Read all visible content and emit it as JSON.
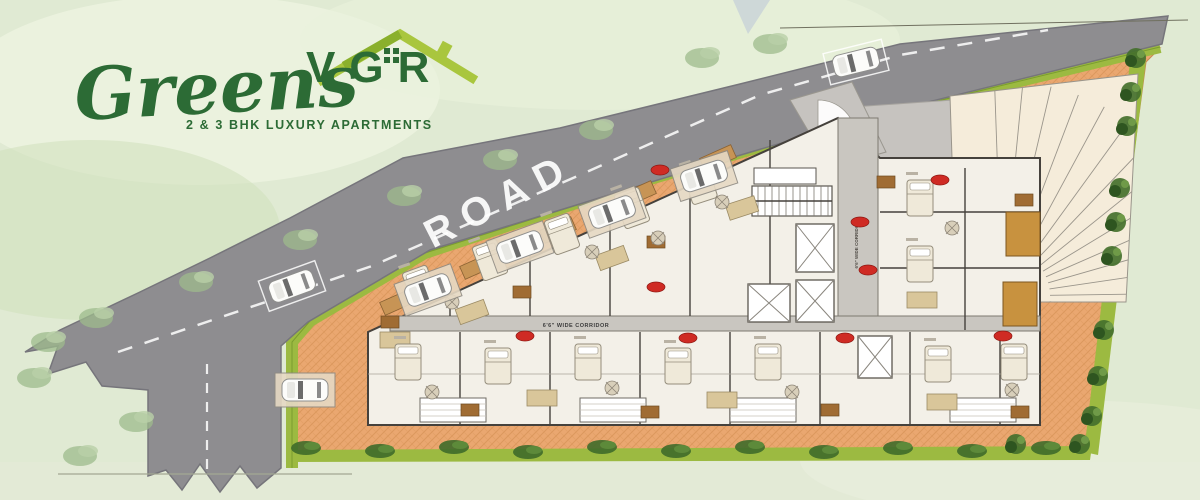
{
  "meta": {
    "title": "VGR Greens – Site / Floor Plan"
  },
  "logo": {
    "brand": "VGR",
    "name": "Greens",
    "tagline": "2 & 3 BHK LUXURY APARTMENTS",
    "dark_green": "#2c6b35",
    "light_green": "#a9c63e"
  },
  "road": {
    "label": "ROAD"
  },
  "plan": {
    "corridor_label": "6'6\" WIDE CORRIDOR",
    "corridor_label_vertical": "6'6\" WIDE CORRIDOR"
  },
  "colors": {
    "bg": "#e0ead3",
    "bg_wash1": "#eef4e1",
    "bg_wash2": "#cfe0bb",
    "road": "#8e8d90",
    "road_edge": "#76757b",
    "dash": "#ffffff",
    "green_strip": "#9cba41",
    "green_dark": "#7a9c2e",
    "plot": "#eaa770",
    "plot_line": "#d08b4e",
    "court": "#c6c3bf",
    "ramp": "#f5ecda",
    "ramp_line": "#9a958b",
    "floor": "#f3f0e8",
    "wall": "#45413c",
    "inner_wall": "#a9a399",
    "tan": "#d9c69a",
    "gold": "#c8923f",
    "brown": "#a06c33",
    "bed": "#efe9d9",
    "bed_line": "#948d7c",
    "badge": "#cf2b24",
    "tree_dark": "#44702c",
    "tree_darker": "#2e5520",
    "tree_light": "#9dbb8c",
    "bush": "#3f6b2a",
    "white": "#ffffff",
    "smudge": "#b9b2a4"
  },
  "cars": {
    "on_road": [
      {
        "x": 856,
        "y": 62,
        "r": -14
      },
      {
        "x": 292,
        "y": 286,
        "r": -20
      }
    ],
    "in_bays": [
      {
        "x": 428,
        "y": 290,
        "r": -20
      },
      {
        "x": 520,
        "y": 247,
        "r": -20
      },
      {
        "x": 612,
        "y": 212,
        "r": -20
      },
      {
        "x": 704,
        "y": 176,
        "r": -18
      },
      {
        "x": 305,
        "y": 390,
        "r": 0
      }
    ]
  },
  "trees": {
    "dark": [
      {
        "x": 1136,
        "y": 58
      },
      {
        "x": 1131,
        "y": 92
      },
      {
        "x": 1127,
        "y": 126
      },
      {
        "x": 1120,
        "y": 188
      },
      {
        "x": 1116,
        "y": 222
      },
      {
        "x": 1112,
        "y": 256
      },
      {
        "x": 1104,
        "y": 330
      },
      {
        "x": 1098,
        "y": 376
      },
      {
        "x": 1092,
        "y": 416
      },
      {
        "x": 1080,
        "y": 444
      },
      {
        "x": 1016,
        "y": 444
      }
    ],
    "light": [
      {
        "x": 770,
        "y": 44
      },
      {
        "x": 702,
        "y": 58
      },
      {
        "x": 596,
        "y": 130
      },
      {
        "x": 500,
        "y": 160
      },
      {
        "x": 404,
        "y": 196
      },
      {
        "x": 300,
        "y": 240
      },
      {
        "x": 196,
        "y": 282
      },
      {
        "x": 96,
        "y": 318
      },
      {
        "x": 48,
        "y": 342
      },
      {
        "x": 136,
        "y": 422
      },
      {
        "x": 80,
        "y": 456
      },
      {
        "x": 34,
        "y": 378
      }
    ],
    "bushes": [
      {
        "x": 306,
        "y": 448
      },
      {
        "x": 380,
        "y": 451
      },
      {
        "x": 454,
        "y": 447
      },
      {
        "x": 528,
        "y": 452
      },
      {
        "x": 602,
        "y": 447
      },
      {
        "x": 676,
        "y": 451
      },
      {
        "x": 750,
        "y": 447
      },
      {
        "x": 824,
        "y": 452
      },
      {
        "x": 898,
        "y": 448
      },
      {
        "x": 972,
        "y": 451
      },
      {
        "x": 1046,
        "y": 448
      }
    ]
  },
  "building": {
    "badges": [
      {
        "x": 660,
        "y": 170
      },
      {
        "x": 656,
        "y": 287
      },
      {
        "x": 860,
        "y": 222
      },
      {
        "x": 868,
        "y": 270
      },
      {
        "x": 525,
        "y": 336
      },
      {
        "x": 688,
        "y": 338
      },
      {
        "x": 845,
        "y": 338
      },
      {
        "x": 1003,
        "y": 336
      },
      {
        "x": 940,
        "y": 180
      }
    ],
    "lifts": [
      {
        "x": 796,
        "y": 224,
        "w": 38,
        "h": 48
      },
      {
        "x": 796,
        "y": 280,
        "w": 38,
        "h": 42
      },
      {
        "x": 748,
        "y": 284,
        "w": 42,
        "h": 38
      },
      {
        "x": 858,
        "y": 336,
        "w": 34,
        "h": 42
      }
    ],
    "stairs": [
      {
        "x": 752,
        "y": 186,
        "w": 80,
        "h": 30
      }
    ],
    "lobby": [
      {
        "x": 754,
        "y": 168,
        "w": 62,
        "h": 16
      }
    ],
    "balconies": [
      {
        "x": 420,
        "y": 398,
        "w": 66,
        "h": 24
      },
      {
        "x": 580,
        "y": 398,
        "w": 66,
        "h": 24
      },
      {
        "x": 730,
        "y": 398,
        "w": 66,
        "h": 24
      },
      {
        "x": 950,
        "y": 398,
        "w": 66,
        "h": 24
      }
    ],
    "gold_balconies": [
      {
        "x": 1006,
        "y": 212,
        "w": 34,
        "h": 44
      },
      {
        "x": 1003,
        "y": 282,
        "w": 34,
        "h": 44
      }
    ],
    "wedges": [
      {
        "x": 398,
        "y": 302
      },
      {
        "x": 478,
        "y": 266
      },
      {
        "x": 558,
        "y": 230
      },
      {
        "x": 638,
        "y": 194
      },
      {
        "x": 718,
        "y": 158
      }
    ],
    "beds": [
      {
        "x": 420,
        "y": 286,
        "r": -20
      },
      {
        "x": 490,
        "y": 260,
        "r": -20
      },
      {
        "x": 562,
        "y": 234,
        "r": -20
      },
      {
        "x": 632,
        "y": 208,
        "r": -20
      },
      {
        "x": 700,
        "y": 184,
        "r": -18
      },
      {
        "x": 920,
        "y": 198,
        "r": 0
      },
      {
        "x": 920,
        "y": 264,
        "r": 0
      },
      {
        "x": 408,
        "y": 362,
        "r": 0
      },
      {
        "x": 498,
        "y": 366,
        "r": 0
      },
      {
        "x": 588,
        "y": 362,
        "r": 0
      },
      {
        "x": 678,
        "y": 366,
        "r": 0
      },
      {
        "x": 768,
        "y": 362,
        "r": 0
      },
      {
        "x": 938,
        "y": 364,
        "r": 0
      },
      {
        "x": 1014,
        "y": 362,
        "r": 0
      }
    ],
    "tables": [
      {
        "x": 452,
        "y": 302
      },
      {
        "x": 592,
        "y": 252
      },
      {
        "x": 722,
        "y": 202
      },
      {
        "x": 952,
        "y": 228
      },
      {
        "x": 432,
        "y": 392
      },
      {
        "x": 612,
        "y": 388
      },
      {
        "x": 792,
        "y": 392
      },
      {
        "x": 1012,
        "y": 390
      },
      {
        "x": 658,
        "y": 238
      }
    ],
    "kitchens": [
      {
        "x": 472,
        "y": 312,
        "r": -20
      },
      {
        "x": 612,
        "y": 258,
        "r": -20
      },
      {
        "x": 742,
        "y": 208,
        "r": -18
      },
      {
        "x": 922,
        "y": 300,
        "r": 0
      },
      {
        "x": 542,
        "y": 398,
        "r": 0
      },
      {
        "x": 722,
        "y": 400,
        "r": 0
      },
      {
        "x": 942,
        "y": 402,
        "r": 0
      },
      {
        "x": 395,
        "y": 340,
        "r": 0
      }
    ],
    "browns": [
      {
        "x": 390,
        "y": 322
      },
      {
        "x": 522,
        "y": 292
      },
      {
        "x": 656,
        "y": 242
      },
      {
        "x": 886,
        "y": 182
      },
      {
        "x": 1024,
        "y": 200
      },
      {
        "x": 470,
        "y": 410
      },
      {
        "x": 650,
        "y": 412
      },
      {
        "x": 830,
        "y": 410
      },
      {
        "x": 1020,
        "y": 412
      }
    ]
  }
}
